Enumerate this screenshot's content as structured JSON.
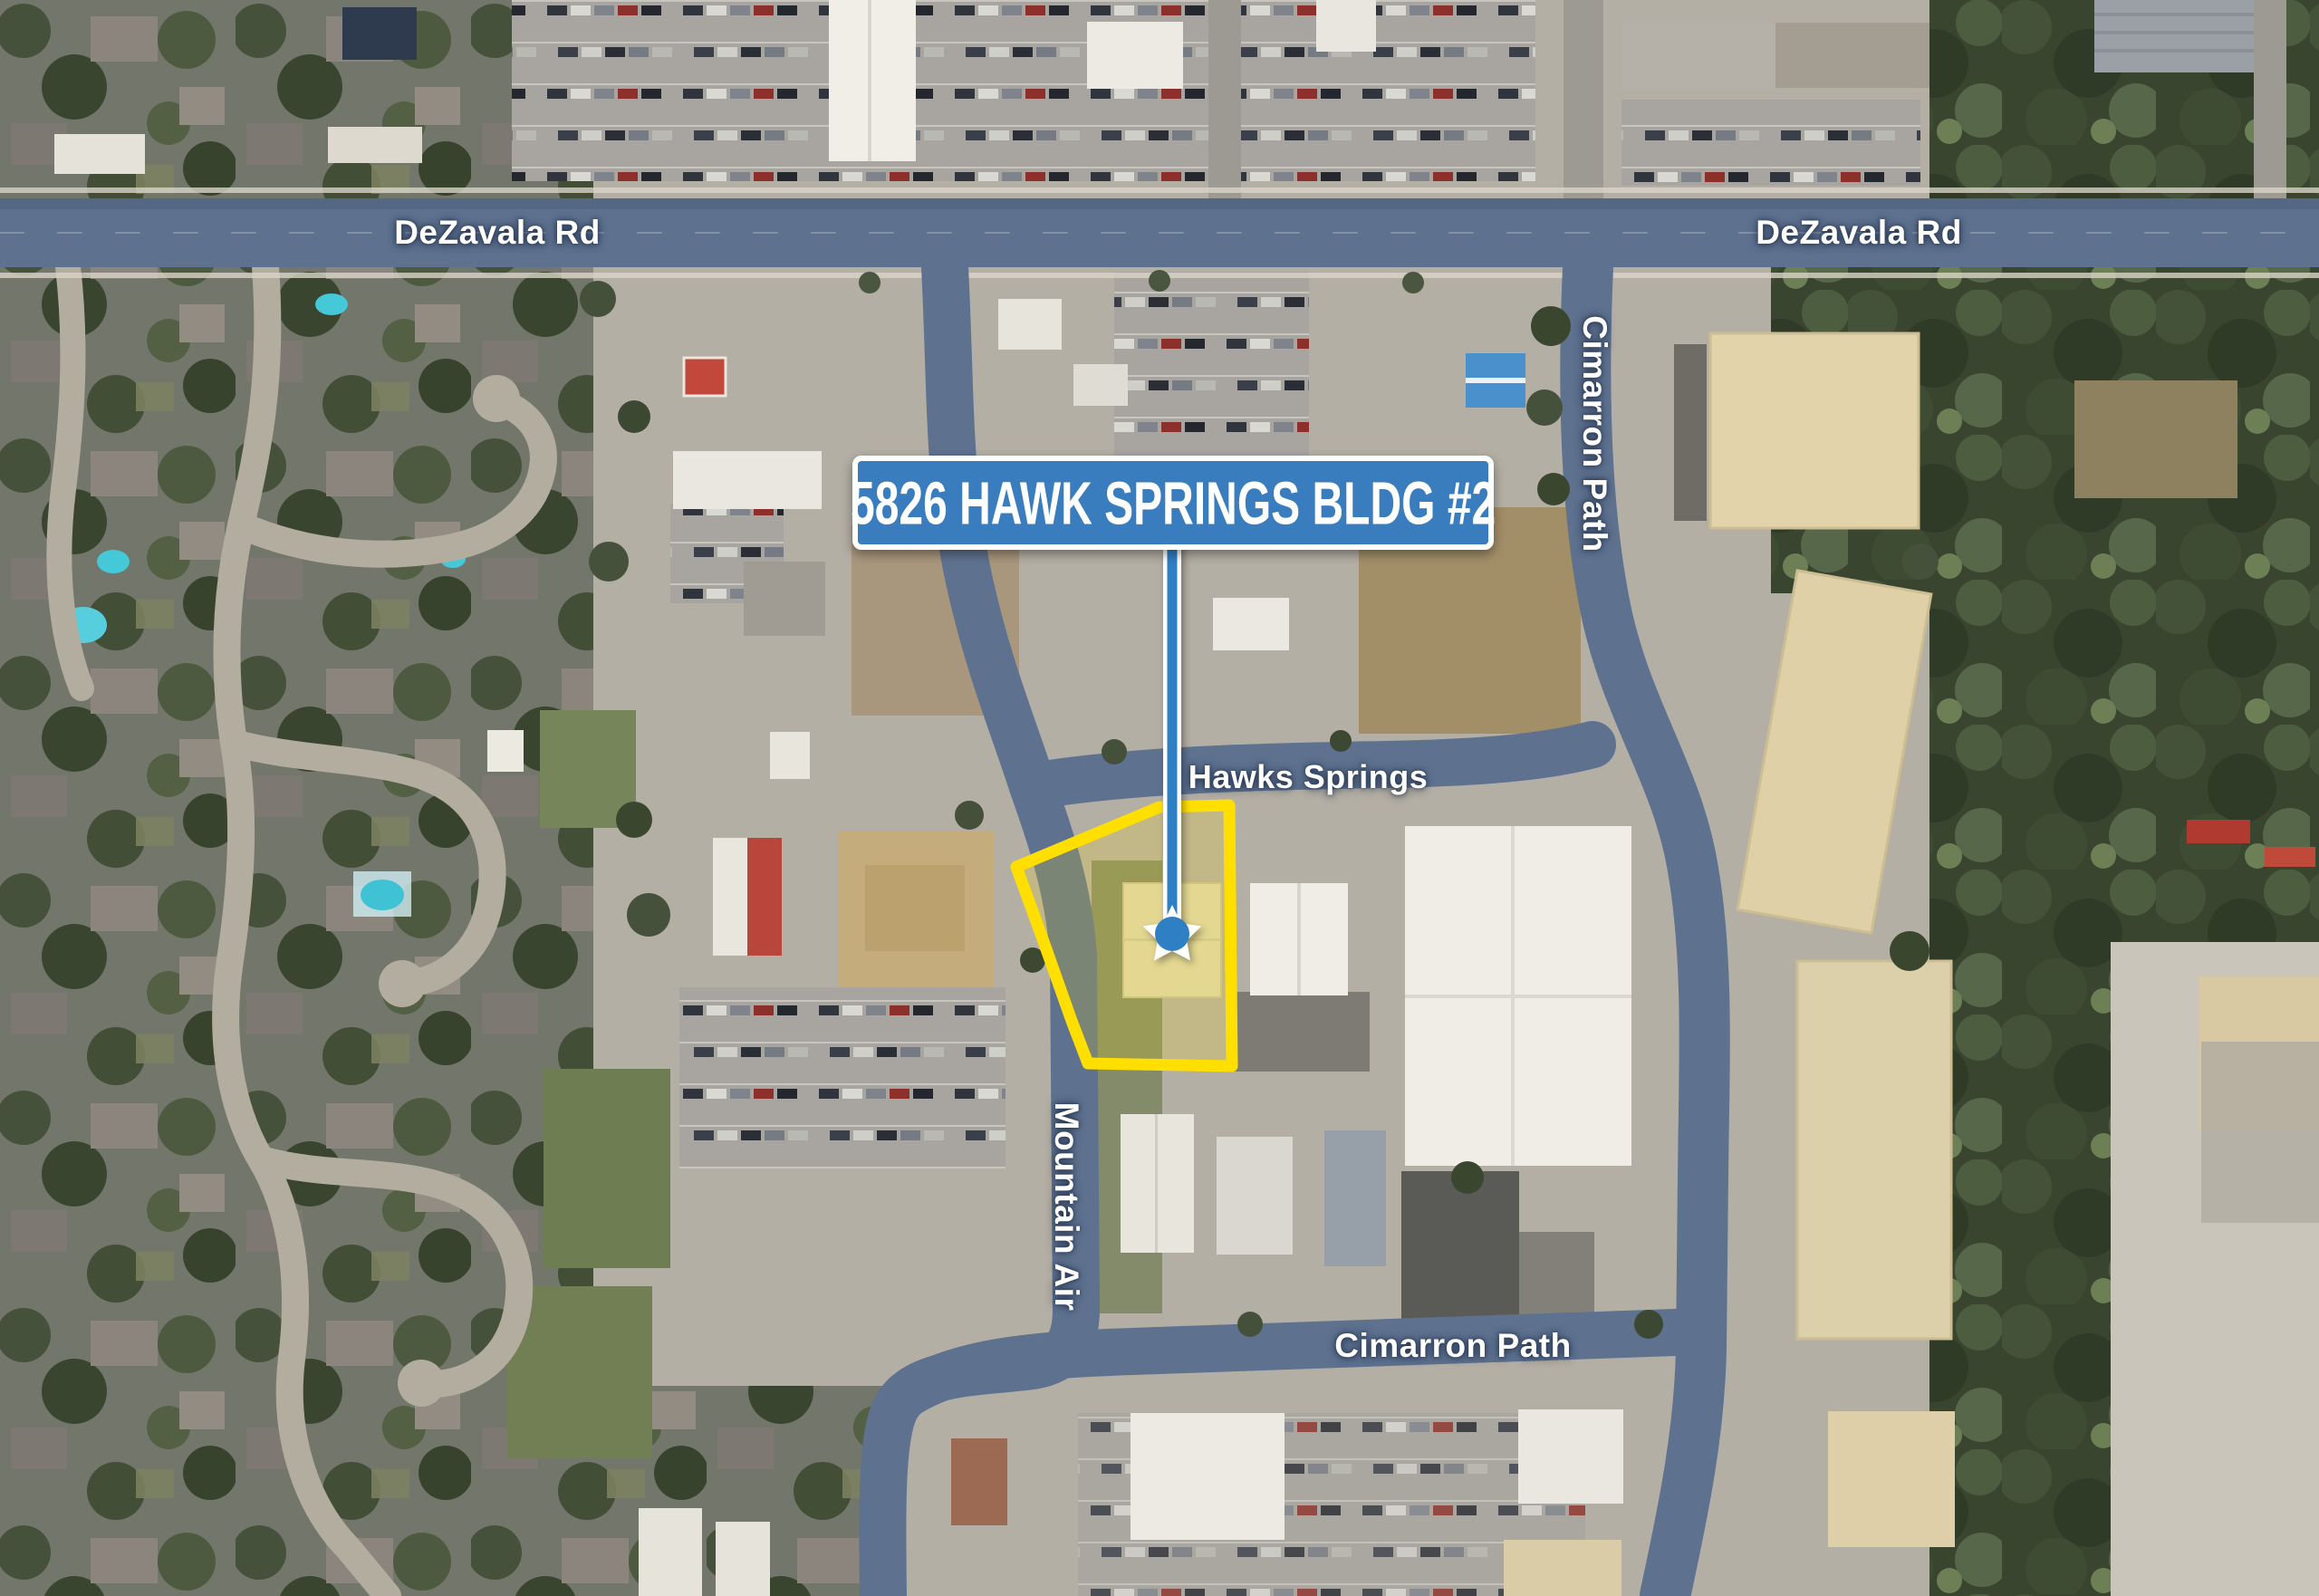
{
  "map": {
    "callout": {
      "label": "5826 HAWK SPRINGS BLDG #2"
    },
    "roads": {
      "dezavala_left": "DeZavala Rd",
      "dezavala_right": "DeZavala Rd",
      "cimarron_top": "Cimarron Path",
      "hawks_springs": "Hawks Springs",
      "mountain_air": "Mountain Air",
      "cimarron_bottom": "Cimarron Path"
    },
    "marker": {
      "icon": "star-icon",
      "shape": "star"
    },
    "colors": {
      "callout_blue": "#3A7DBF",
      "marker_blue": "#2E7FC4",
      "parcel_yellow": "#FFDF00",
      "road_tint": "#5E7290",
      "label_white": "#FFFFFF"
    }
  }
}
